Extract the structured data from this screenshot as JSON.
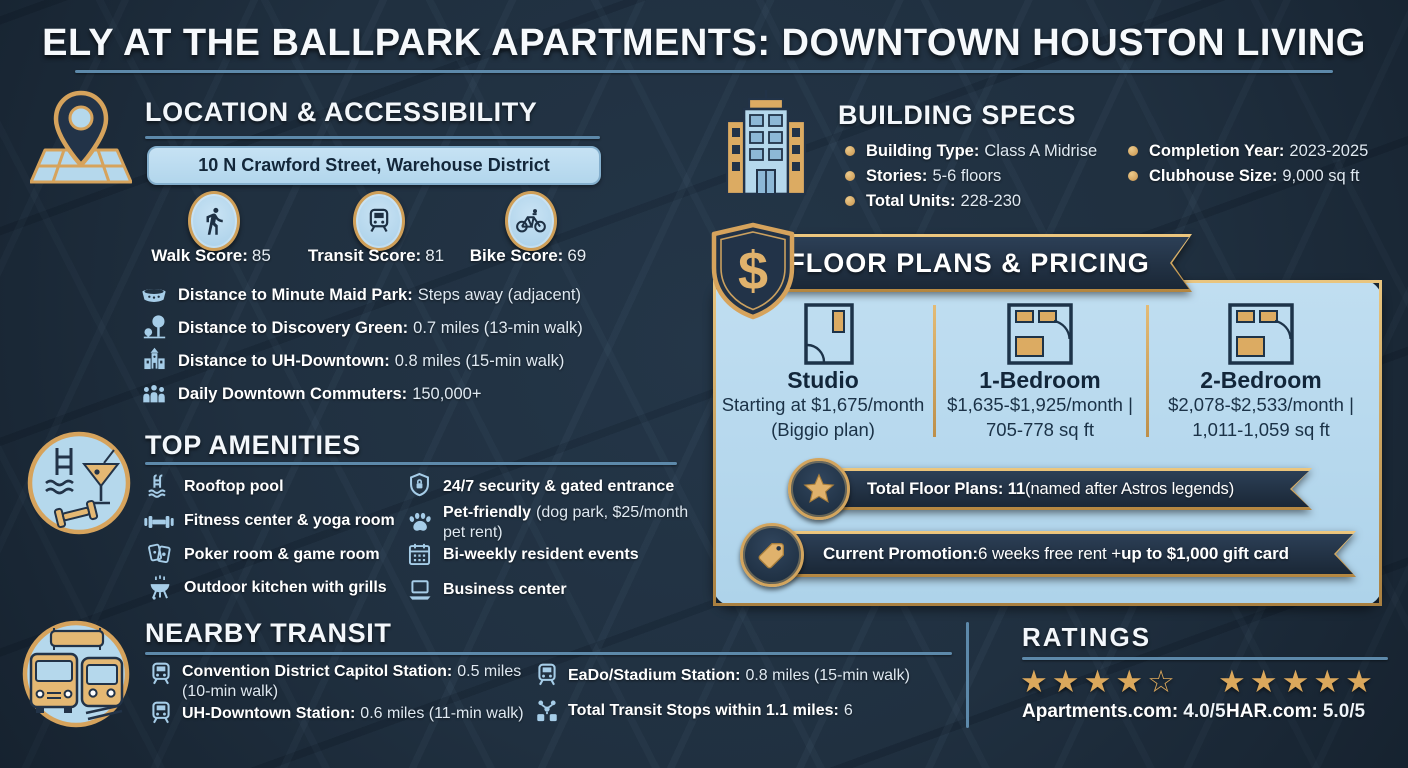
{
  "title": "ELY AT THE BALLPARK APARTMENTS: DOWNTOWN HOUSTON LIVING",
  "location": {
    "heading": "LOCATION & ACCESSIBILITY",
    "address": "10 N Crawford Street, Warehouse District",
    "scores": [
      {
        "icon": "walk-icon",
        "label": "Walk Score:",
        "value": "85"
      },
      {
        "icon": "train-icon",
        "label": "Transit Score:",
        "value": "81"
      },
      {
        "icon": "bike-icon",
        "label": "Bike Score:",
        "value": "69"
      }
    ],
    "distances": [
      {
        "icon": "stadium-icon",
        "label": "Distance to Minute Maid Park:",
        "value": "Steps away (adjacent)"
      },
      {
        "icon": "park-icon",
        "label": "Distance to Discovery Green:",
        "value": "0.7 miles (13-min walk)"
      },
      {
        "icon": "university-icon",
        "label": "Distance to UH-Downtown:",
        "value": "0.8 miles (15-min walk)"
      },
      {
        "icon": "commuters-icon",
        "label": "Daily Downtown Commuters:",
        "value": "150,000+"
      }
    ]
  },
  "amenities": {
    "heading": "TOP AMENITIES",
    "col1": [
      {
        "icon": "pool-icon",
        "label": "Rooftop pool",
        "value": ""
      },
      {
        "icon": "dumbbell-icon",
        "label": "Fitness center & yoga room",
        "value": ""
      },
      {
        "icon": "cards-icon",
        "label": "Poker room & game room",
        "value": ""
      },
      {
        "icon": "grill-icon",
        "label": "Outdoor kitchen with grills",
        "value": ""
      }
    ],
    "col2": [
      {
        "icon": "security-icon",
        "label": "24/7 security & gated entrance",
        "value": ""
      },
      {
        "icon": "paw-icon",
        "label": "Pet-friendly",
        "value": "(dog park, $25/month pet rent)"
      },
      {
        "icon": "calendar-icon",
        "label": "Bi-weekly resident events",
        "value": ""
      },
      {
        "icon": "laptop-icon",
        "label": "Business center",
        "value": ""
      }
    ]
  },
  "transit": {
    "heading": "NEARBY TRANSIT",
    "col1": [
      {
        "icon": "station-icon",
        "label": "Convention District Capitol Station:",
        "value": "0.5 miles (10-min walk)"
      },
      {
        "icon": "station-icon",
        "label": "UH-Downtown Station:",
        "value": "0.6 miles (11-min walk)"
      }
    ],
    "col2": [
      {
        "icon": "station-icon",
        "label": "EaDo/Stadium Station:",
        "value": "0.8 miles (15-min walk)"
      },
      {
        "icon": "transit-network-icon",
        "label": "Total Transit Stops within 1.1 miles:",
        "value": "6"
      }
    ]
  },
  "building_specs": {
    "heading": "BUILDING SPECS",
    "col1": [
      {
        "label": "Building Type:",
        "value": "Class A Midrise"
      },
      {
        "label": "Stories:",
        "value": "5-6 floors"
      },
      {
        "label": "Total Units:",
        "value": "228-230"
      }
    ],
    "col2": [
      {
        "label": "Completion Year:",
        "value": "2023-2025"
      },
      {
        "label": "Clubhouse Size:",
        "value": "9,000 sq ft"
      }
    ]
  },
  "floor_plans": {
    "heading": "FLOOR PLANS & PRICING",
    "currency_symbol": "$",
    "plans": [
      {
        "name": "Studio",
        "line1": "Starting at $1,675/month",
        "line2": "(Biggio plan)"
      },
      {
        "name": "1-Bedroom",
        "line1": "$1,635-$1,925/month |",
        "line2": "705-778 sq ft"
      },
      {
        "name": "2-Bedroom",
        "line1": "$2,078-$2,533/month |",
        "line2": "1,011-1,059 sq ft"
      }
    ],
    "total_plans": {
      "bold": "Total Floor Plans: 11",
      "rest": " (named after Astros legends)"
    },
    "promotion": {
      "bold1": "Current Promotion:",
      "rest": " 6 weeks free rent + ",
      "bold2": "up to $1,000 gift card"
    }
  },
  "ratings": {
    "heading": "RATINGS",
    "entries": [
      {
        "stars": "★★★★☆",
        "label": "Apartments.com:",
        "value": "4.0/5"
      },
      {
        "stars": "★★★★★",
        "label": "HAR.com:",
        "value": "5.0/5"
      }
    ]
  },
  "colors": {
    "background": "#203040",
    "panel_blue": "#b5d8ec",
    "gold": "#d6a35c",
    "ribbon_navy": "#223348",
    "accent_line": "#5d89aa"
  }
}
